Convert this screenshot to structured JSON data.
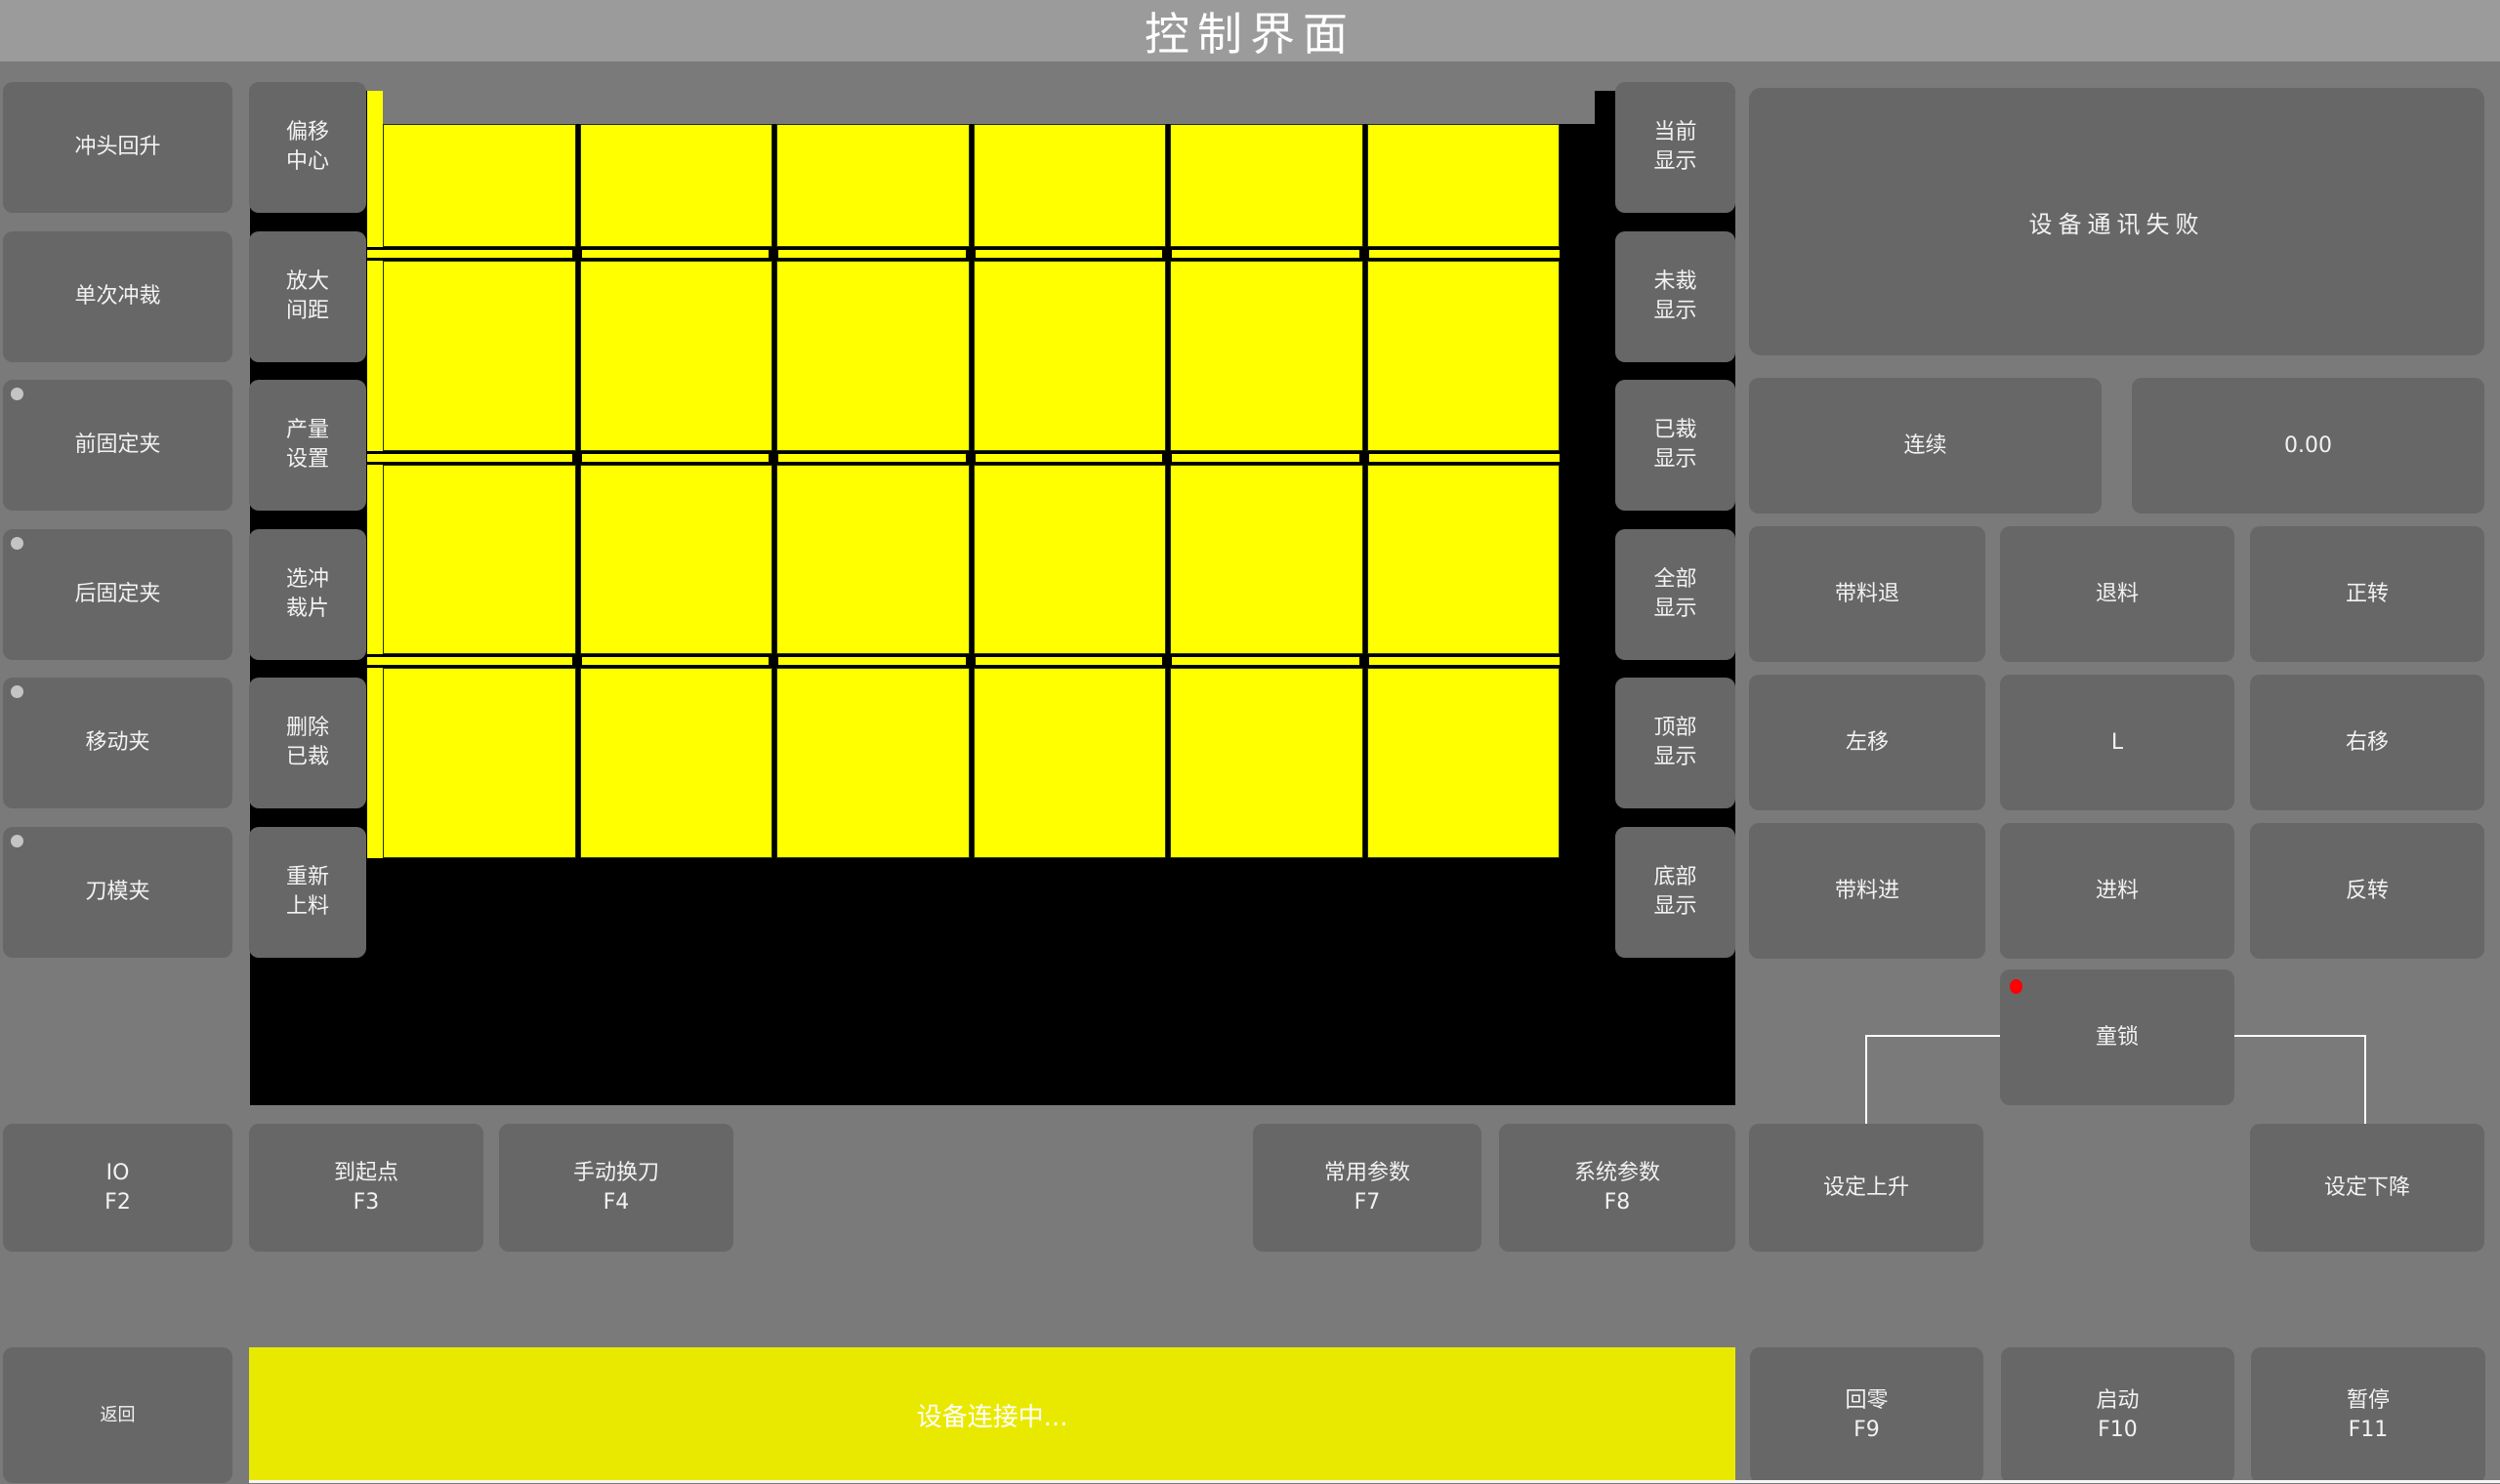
{
  "title": "控制界面",
  "left_buttons": [
    {
      "label": "冲头回升",
      "dot": false
    },
    {
      "label": "单次冲裁",
      "dot": false
    },
    {
      "label": "前固定夹",
      "dot": true
    },
    {
      "label": "后固定夹",
      "dot": true
    },
    {
      "label": "移动夹",
      "dot": true
    },
    {
      "label": "刀模夹",
      "dot": true
    }
  ],
  "tool_buttons": [
    {
      "label": "偏移\n中心"
    },
    {
      "label": "放大\n间距"
    },
    {
      "label": "产量\n设置"
    },
    {
      "label": "选冲\n裁片"
    },
    {
      "label": "删除\n已裁"
    },
    {
      "label": "重新\n上料"
    }
  ],
  "display_buttons": [
    {
      "label": "当前\n显示"
    },
    {
      "label": "未裁\n显示"
    },
    {
      "label": "已裁\n显示"
    },
    {
      "label": "全部\n显示"
    },
    {
      "label": "顶部\n显示"
    },
    {
      "label": "底部\n显示"
    }
  ],
  "canvas": {
    "columns": 6,
    "rows": 4,
    "piece_color": "#ffff00",
    "background": "#000000"
  },
  "right_panel": {
    "message": "设备通讯失败",
    "mode_button": "连续",
    "value_display": "0.00",
    "jog_buttons": [
      "带料退",
      "退料",
      "正转",
      "左移",
      "L",
      "右移",
      "带料进",
      "进料",
      "反转"
    ],
    "child_lock": {
      "label": "童锁",
      "alarm_color": "#ff0000"
    }
  },
  "function_buttons": [
    {
      "label": "IO\nF2"
    },
    {
      "label": "到起点\nF3"
    },
    {
      "label": "手动换刀\nF4"
    },
    {
      "label": "常用参数\nF7"
    },
    {
      "label": "系统参数\nF8"
    },
    {
      "label": "设定上升"
    },
    {
      "label": "设定下降"
    }
  ],
  "bottom_bar": {
    "back_button": "返回",
    "status_message": "设备连接中...",
    "buttons": [
      {
        "label": "回零\nF9"
      },
      {
        "label": "启动\nF10"
      },
      {
        "label": "暂停\nF11"
      }
    ]
  },
  "colors": {
    "accent_yellow": "#ffff00",
    "status_bar_yellow": "#e9e900",
    "alarm_red": "#ff0000"
  }
}
